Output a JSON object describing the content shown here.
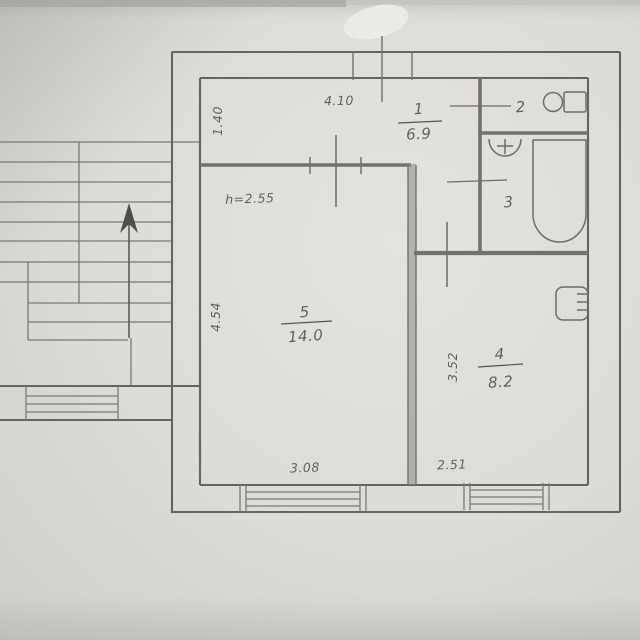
{
  "plan": {
    "rooms": [
      {
        "number": "1",
        "area": "6.9"
      },
      {
        "number": "2"
      },
      {
        "number": "3"
      },
      {
        "number": "4",
        "area": "8.2"
      },
      {
        "number": "5",
        "area": "14.0"
      }
    ],
    "dimensions": {
      "hall_width": "4.10",
      "hall_depth": "1.40",
      "ceiling_height": "h=2.55",
      "room5_depth": "4.54",
      "room5_width": "3.08",
      "room4_depth": "3.52",
      "room4_width": "2.51"
    },
    "symbols": {
      "stairs": "stairs-up-arrow-icon",
      "toilet": "toilet-icon",
      "sink": "sink-icon",
      "bathtub": "bathtub-icon",
      "radiator": "radiator-icon",
      "windows": "window-symbol"
    }
  }
}
